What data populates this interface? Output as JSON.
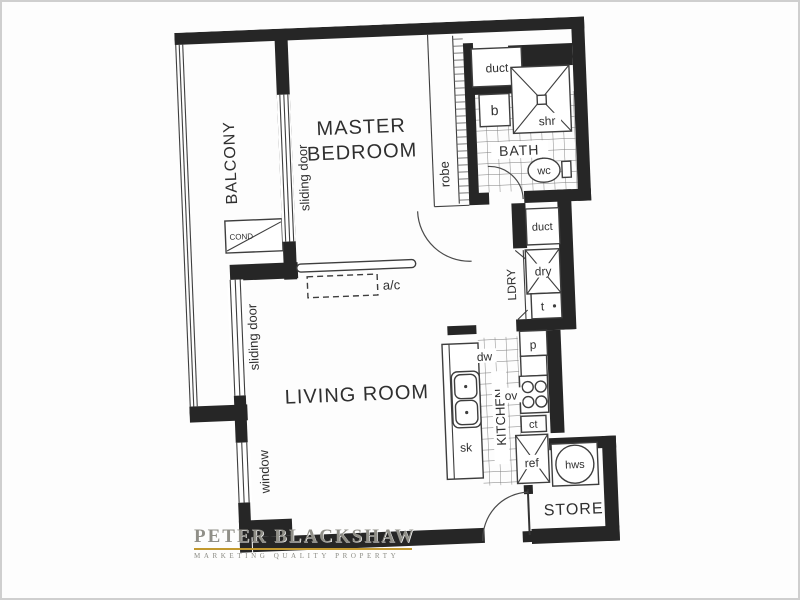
{
  "colors": {
    "wall": "#262626",
    "line": "#3e3e3e",
    "text": "#2f2f2f",
    "gold": "#c2992f",
    "brand_text": "#908f88"
  },
  "plan": {
    "rooms": {
      "balcony": "BALCONY",
      "master_line1": "MASTER",
      "master_line2": "BEDROOM",
      "living": "LIVING ROOM",
      "bath": "BATH",
      "laundry": "LDRY",
      "kitchen": "KITCHEN",
      "store": "STORE"
    },
    "fixtures": {
      "duct_top": "duct",
      "duct_mid": "duct",
      "basin": "b",
      "shower": "shr",
      "wc": "wc",
      "dryer": "dry",
      "tub": "t",
      "pantry": "p",
      "oven": "ov",
      "counter": "ct",
      "fridge": "ref",
      "hot_water": "hws",
      "sink": "sk",
      "dishwasher": "dw",
      "robe": "robe",
      "aircon": "a/c",
      "condenser": "COND"
    },
    "openings": {
      "sliding_door_bedroom": "sliding door",
      "sliding_door_living": "sliding door",
      "window": "window"
    }
  },
  "brand": {
    "name": "PETER BLACKSHAW",
    "tagline": "MARKETING QUALITY PROPERTY"
  }
}
